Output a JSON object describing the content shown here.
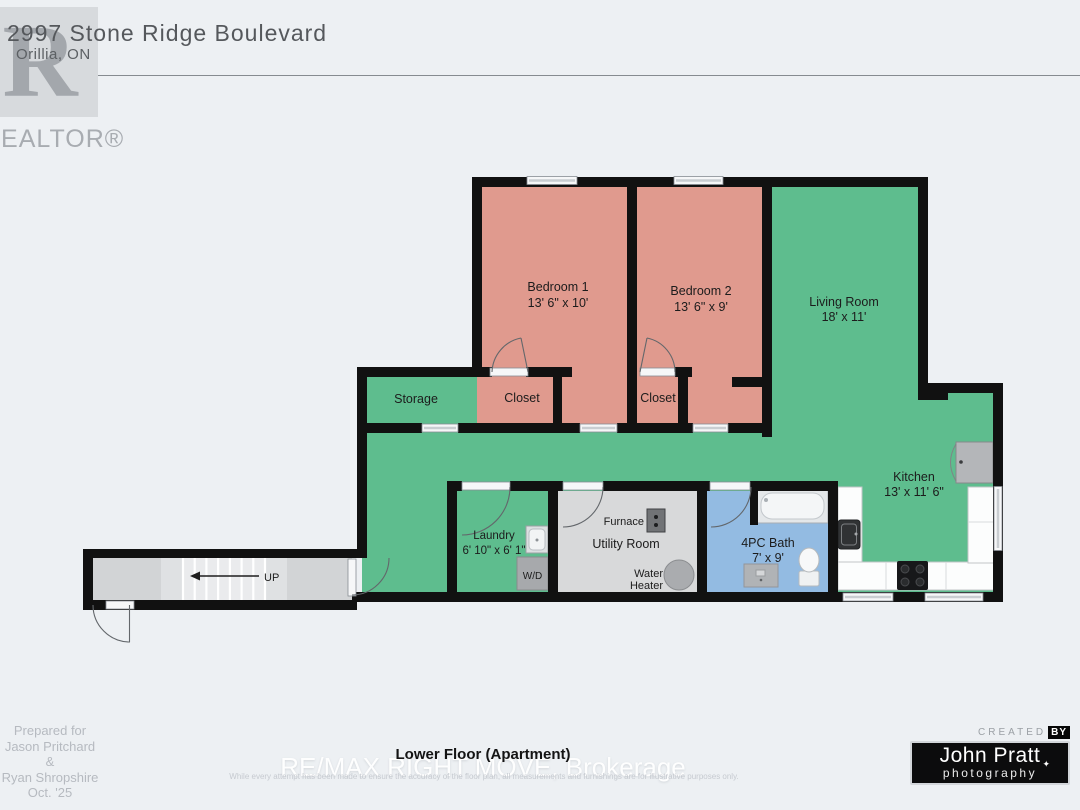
{
  "header": {
    "address_line1": "2997 Stone Ridge Boulevard",
    "address_line2": "Orillia, ON",
    "realtor_logo": {
      "letter": "R",
      "wordmark": "REALTOR®"
    }
  },
  "floor_plan": {
    "rooms": [
      {
        "name": "Bedroom 1",
        "dims": "13' 6\" x 10'"
      },
      {
        "name": "Bedroom 2",
        "dims": "13' 6\" x 9'"
      },
      {
        "name": "Living Room",
        "dims": "18' x 11'"
      },
      {
        "name": "Kitchen",
        "dims": "13' x 11' 6\""
      },
      {
        "name": "Laundry",
        "dims": "6' 10\" x 6' 1\""
      },
      {
        "name": "Utility Room",
        "dims": ""
      },
      {
        "name": "4PC Bath",
        "dims": "7' x 9'"
      },
      {
        "name": "Storage",
        "dims": ""
      },
      {
        "name": "Closet",
        "dims": ""
      },
      {
        "name": "Closet",
        "dims": ""
      }
    ],
    "fixtures": {
      "washer_dryer": "W/D",
      "furnace": "Furnace",
      "water_heater_line1": "Water",
      "water_heater_line2": "Heater",
      "stairs_direction": "UP"
    },
    "colors": {
      "wall": "#111111",
      "bedroom_salmon": "#e09a8e",
      "living_green": "#5ebd8e",
      "bath_blue": "#93bbe2",
      "utility_gray": "#d8d9da",
      "corridor_gray": "#d2d4d6"
    }
  },
  "footer": {
    "prepared_for": [
      "Prepared for",
      "Jason Pritchard &",
      "Ryan Shropshire",
      "Oct. '25"
    ],
    "plan_title": "Lower Floor (Apartment)",
    "watermark": "RE/MAX RIGHT MOVE, Brokerage",
    "disclaimer": "While every attempt has been made to ensure the accuracy of the floor plan, all measurements and furnishings are for illustrative purposes only.",
    "credit": {
      "created_label": "CREATED",
      "by_label": "BY",
      "name": "John Pratt",
      "tagline": "photography"
    }
  }
}
